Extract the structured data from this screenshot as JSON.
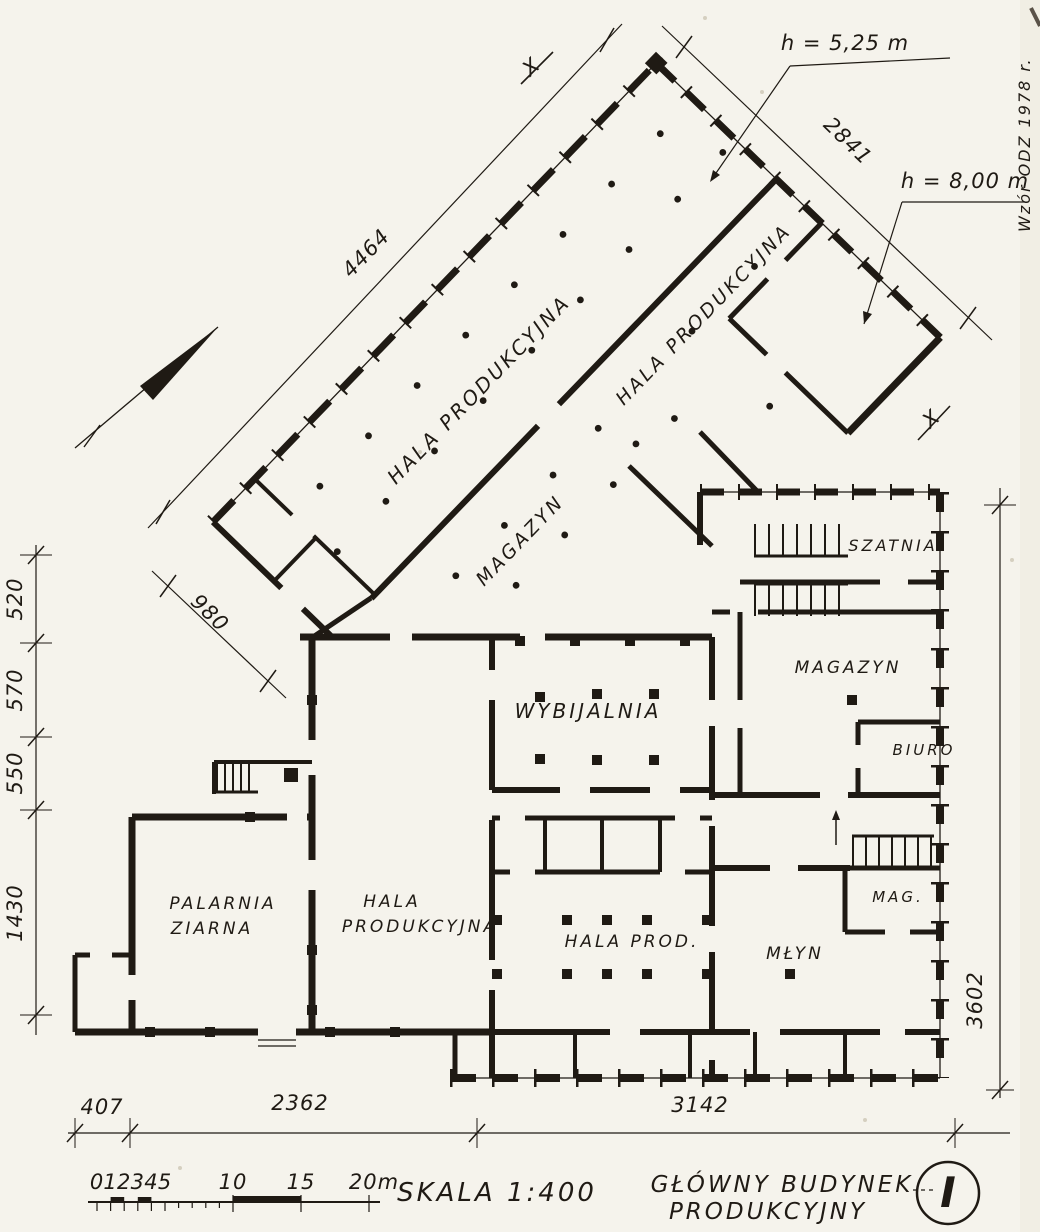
{
  "drawing": {
    "paper_color": "#f5f3ec",
    "ink_color": "#1f1a14",
    "watermark": "Wzór ODZ 1978 r.",
    "section_marker": "X"
  },
  "rooms": {
    "hala_rot_1": "HALA PRODUKCYJNA",
    "hala_rot_2": "HALA PRODUKCYJNA",
    "magazyn_rot": "MAGAZYN",
    "wybijalnia": "WYBIJALNIA",
    "szatnia": "SZATNIA",
    "magazyn_right": "MAGAZYN",
    "biuro": "BIURO",
    "mag": "MAG.",
    "mlyn": "MŁYN",
    "hala_prod": "HALA PROD.",
    "palarnia_l1": "PALARNIA",
    "palarnia_l2": "ZIARNA",
    "hala_bottom_l1": "HALA",
    "hala_bottom_l2": "PRODUKCYJNA"
  },
  "dimensions": {
    "top_left": "4464",
    "top_right": "2841",
    "annex": "980",
    "left_chain": [
      "520",
      "570",
      "550",
      "1430"
    ],
    "right_side": "3602",
    "bottom_chain": [
      "407",
      "2362",
      "3142"
    ],
    "height_1": "h = 5,25 m",
    "height_2": "h = 8,00 m"
  },
  "scale_bar": {
    "labels": [
      "0",
      "1",
      "2",
      "3",
      "4",
      "5",
      "10",
      "15",
      "20m"
    ]
  },
  "title_block": {
    "scale": "SKALA 1:400",
    "title_l1": "GŁÓWNY BUDYNEK",
    "title_l2": "PRODUKCYJNY",
    "sheet": "I"
  }
}
